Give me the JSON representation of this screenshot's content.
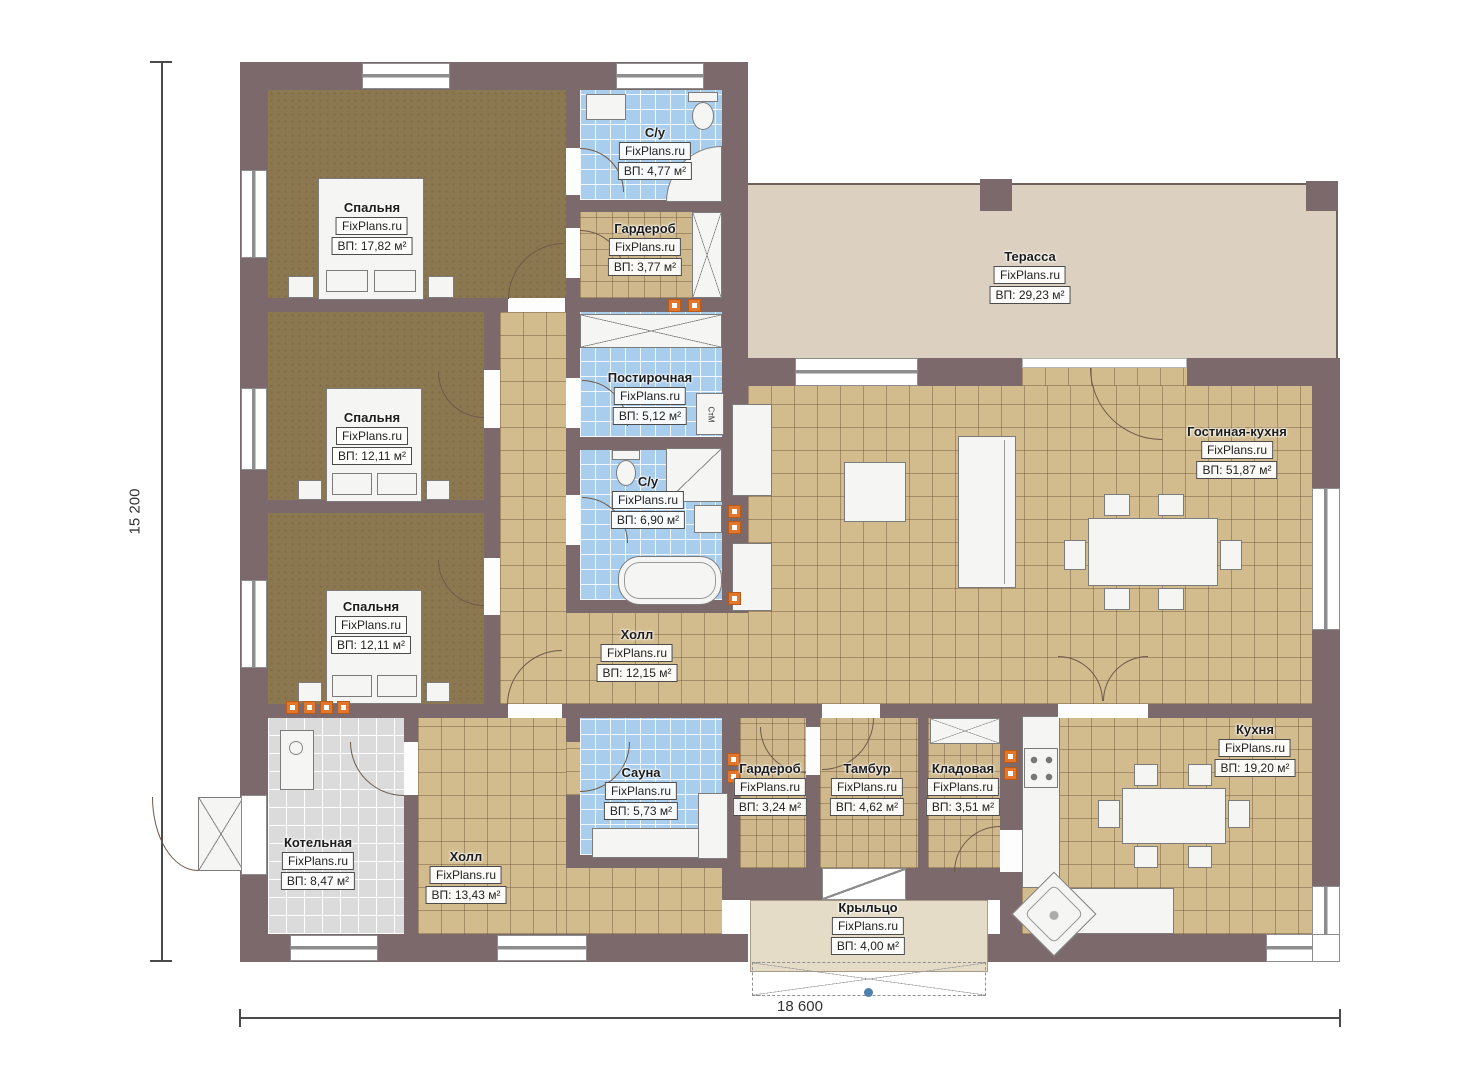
{
  "watermark": "FixPlans.ru",
  "dimensions": {
    "width_label": "18 600",
    "height_label": "15 200"
  },
  "appliances": {
    "washer": "СтМ"
  },
  "colors": {
    "wall": "#7c696b",
    "floor_tile_tan": "#d2bc8e",
    "floor_tile_blue": "#a9cdec",
    "floor_bedroom": "#8c7850",
    "floor_boiler": "#dbdbdb",
    "terrace": "#dcd1c0",
    "porch": "#e5dcc8",
    "utility_marker": "#e1762c"
  },
  "rooms": {
    "bedroom1": {
      "name": "Спальня",
      "area": "ВП: 17,82 м²"
    },
    "ensuite": {
      "name": "С/у",
      "area": "ВП: 4,77 м²"
    },
    "wardrobe1": {
      "name": "Гардероб",
      "area": "ВП: 3,77 м²"
    },
    "terrace": {
      "name": "Терасса",
      "area": "ВП: 29,23 м²"
    },
    "bedroom2": {
      "name": "Спальня",
      "area": "ВП: 12,11 м²"
    },
    "laundry": {
      "name": "Постирочная",
      "area": "ВП: 5,12 м²"
    },
    "bathroom": {
      "name": "С/у",
      "area": "ВП: 6,90 м²"
    },
    "living": {
      "name": "Гостиная-кухня",
      "area": "ВП: 51,87 м²"
    },
    "bedroom3": {
      "name": "Спальня",
      "area": "ВП: 12,11 м²"
    },
    "hall1": {
      "name": "Холл",
      "area": "ВП: 12,15 м²"
    },
    "boiler": {
      "name": "Котельная",
      "area": "ВП: 8,47 м²"
    },
    "hall2": {
      "name": "Холл",
      "area": "ВП: 13,43 м²"
    },
    "sauna": {
      "name": "Сауна",
      "area": "ВП: 5,73 м²"
    },
    "wardrobe2": {
      "name": "Гардероб",
      "area": "ВП: 3,24 м²"
    },
    "vestibule": {
      "name": "Тамбур",
      "area": "ВП: 4,62 м²"
    },
    "storage": {
      "name": "Кладовая",
      "area": "ВП: 3,51 м²"
    },
    "kitchen": {
      "name": "Кухня",
      "area": "ВП: 19,20 м²"
    },
    "porch": {
      "name": "Крыльцо",
      "area": "ВП: 4,00 м²"
    }
  }
}
